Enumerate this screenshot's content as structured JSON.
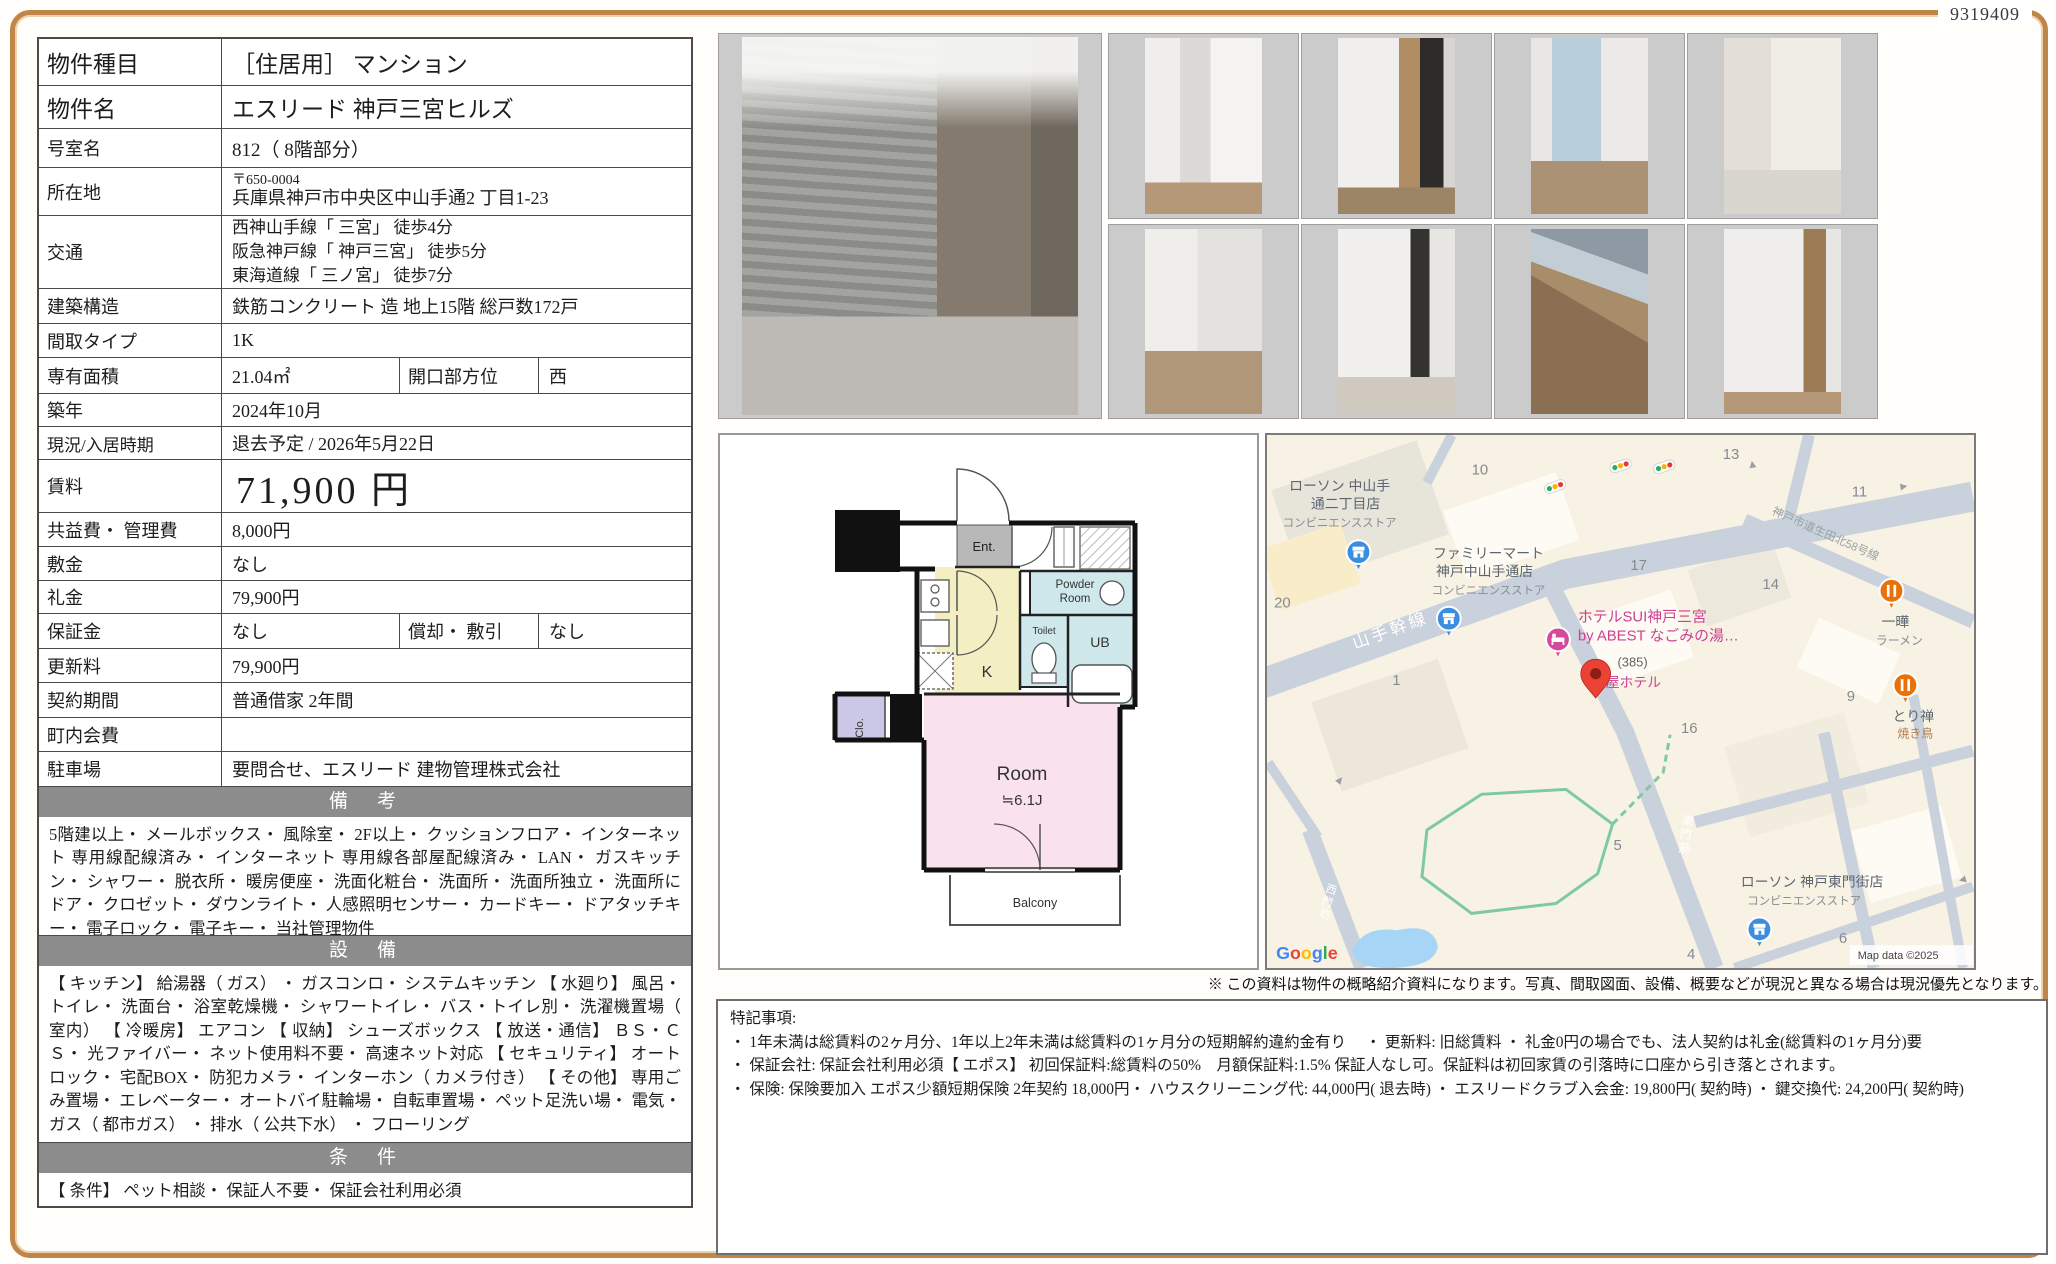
{
  "page": {
    "id_number": "9319409",
    "disclaimer": "※ この資料は物件の概略紹介資料になります。写真、間取図面、設備、概要などが現況と異なる場合は現況優先となります。"
  },
  "table": {
    "rows": {
      "type": {
        "label": "物件種目",
        "value": "［住居用］ マンション"
      },
      "name": {
        "label": "物件名",
        "value": "エスリード 神戸三宮ヒルズ"
      },
      "room_no": {
        "label": "号室名",
        "value": "812（ 8階部分）"
      },
      "address": {
        "label": "所在地",
        "postal": "〒650-0004",
        "value": "兵庫県神戸市中央区中山手通2 丁目1-23"
      },
      "access": {
        "label": "交通",
        "line1": "西神山手線「 三宮」 徒歩4分",
        "line2": "阪急神戸線「 神戸三宮」 徒歩5分",
        "line3": "東海道線「 三ノ宮」 徒歩7分"
      },
      "structure": {
        "label": "建築構造",
        "value": "鉄筋コンクリート 造 地上15階 総戸数172戸"
      },
      "layout": {
        "label": "間取タイプ",
        "value": "1K"
      },
      "area": {
        "label": "専有面積",
        "value": "21.04㎡",
        "label2": "開口部方位",
        "value2": "西"
      },
      "built": {
        "label": "築年",
        "value": "2024年10月"
      },
      "status": {
        "label": "現況/入居時期",
        "value": "退去予定 / 2026年5月22日"
      },
      "rent": {
        "label": "賃料",
        "value": "71,900 円"
      },
      "fees": {
        "label": "共益費・ 管理費",
        "value": "8,000円"
      },
      "deposit": {
        "label": "敷金",
        "value": "なし"
      },
      "key_money": {
        "label": "礼金",
        "value": "79,900円"
      },
      "guarantee": {
        "label": "保証金",
        "value": "なし",
        "label2": "償却・ 敷引",
        "value2": "なし"
      },
      "renewal": {
        "label": "更新料",
        "value": "79,900円"
      },
      "contract": {
        "label": "契約期間",
        "value": "普通借家 2年間"
      },
      "town_fee": {
        "label": "町内会費",
        "value": ""
      },
      "parking": {
        "label": "駐車場",
        "value": "要問合せ、エスリード 建物管理株式会社"
      }
    },
    "sections": {
      "remarks": {
        "title": "備　考",
        "text": "5階建以上・ メールボックス・ 風除室・ 2F以上・ クッションフロア・ インターネット 専用線配線済み・ インターネット 専用線各部屋配線済み・ LAN・ ガスキッチン・ シャワー・ 脱衣所・ 暖房便座・ 洗面化粧台・ 洗面所・ 洗面所独立・ 洗面所にドア・ クロゼット・ ダウンライト・ 人感照明センサー・ カードキー・ ドアタッチキー・ 電子ロック・ 電子キー・ 当社管理物件"
      },
      "equipment": {
        "title": "設　備",
        "text": "【 キッチン】 給湯器（ ガス） ・ ガスコンロ・ システムキッチン 【 水廻り】 風呂・ トイレ・ 洗面台・ 浴室乾燥機・ シャワートイレ・ バス・トイレ別・ 洗濯機置場（ 室内） 【 冷暖房】 エアコン 【 収納】 シューズボックス 【 放送・通信】 ＢＳ・ＣＳ・ 光ファイバー・ ネット使用料不要・ 高速ネット対応 【 セキュリティ】 オートロック・ 宅配BOX・ 防犯カメラ・ インターホン（ カメラ付き） 【 その他】 専用ごみ置場・ エレベーター・ オートバイ駐輪場・ 自転車置場・ ペット足洗い場・ 電気・ ガス（ 都市ガス） ・ 排水（ 公共下水） ・ フローリング"
      },
      "conditions": {
        "title": "条　件",
        "text": "【 条件】 ペット相談・ 保証人不要・ 保証会社利用必須"
      }
    }
  },
  "photos": {
    "items": [
      "building-exterior",
      "closet",
      "kitchen-entrance",
      "room-window",
      "unit-bath",
      "room-floor",
      "hallway-mirror",
      "balcony-view",
      "washroom"
    ]
  },
  "floorplan": {
    "ent": "Ent.",
    "powder_line1": "Powder",
    "powder_line2": "Room",
    "toilet": "Toilet",
    "ub": "UB",
    "kitchen": "K",
    "closet": "Clo.",
    "room": "Room",
    "room_size": "≒6.1J",
    "balcony": "Balcony"
  },
  "map": {
    "pois": {
      "lawson_nakayamate": {
        "name_line1": "ローソン 中山手",
        "name_line2": "通二丁目店",
        "category": "コンビニエンスストア"
      },
      "familymart": {
        "name_line1": "ファミリーマート",
        "name_line2": "神戸中山手通店",
        "category": "コンビニエンスストア"
      },
      "hotel_sui": {
        "name_line1": "ホテルSUI神戸三宮",
        "name_line2": "by ABEST なごみの湯…",
        "ref": "(385)",
        "name_line3": "屋ホテル"
      },
      "ramen": {
        "name": "一曄",
        "category": "ラーメン"
      },
      "yakitori": {
        "name": "とり禅",
        "category": "焼き鳥"
      },
      "lawson_higashimon": {
        "name": "ローソン 神戸東門街店",
        "category": "コンビニエンスストア"
      }
    },
    "roads": {
      "yamate": "山手幹線",
      "route58": "神戸市道生田北58号線",
      "higashimon": "東門筋",
      "nishimon": "西門筋"
    },
    "blocks": [
      "10",
      "13",
      "11",
      "17",
      "14",
      "20",
      "1",
      "16",
      "9",
      "5",
      "6",
      "4"
    ],
    "google_logo": "Google",
    "attribution": "Map data ©2025"
  },
  "notes": {
    "title": "特記事項:",
    "line1": "・ 1年未満は総賃料の2ヶ月分、1年以上2年未満は総賃料の1ヶ月分の短期解約違約金有り　 ・ 更新料: 旧総賃料 ・ 礼金0円の場合でも、法人契約は礼金(総賃料の1ヶ月分)要",
    "line2": "・ 保証会社: 保証会社利用必須【 エポス】 初回保証料:総賃料の50%　月額保証料:1.5% 保証人なし可。保証料は初回家賃の引落時に口座から引き落とされます。",
    "line3": "・ 保険: 保険要加入 エポス少額短期保険 2年契約 18,000円・ ハウスクリーニング代: 44,000円( 退去時) ・ エスリードクラブ入会金: 19,800円( 契約時) ・ 鍵交換代: 24,200円( 契約時)"
  },
  "colors": {
    "frame_accent": "#c08548",
    "section_header_bg": "#8c8c8c",
    "fp_room_pink": "#f9e2ee",
    "fp_kitchen_yellow": "#f4eec3",
    "fp_wet_blue": "#cfe8ec",
    "fp_closet_lavender": "#cbc7e6",
    "map_pin_red": "#ea4335",
    "map_store_blue": "#3b8de0",
    "map_food_orange": "#e8710a",
    "map_hotel_pink": "#d6489b"
  }
}
